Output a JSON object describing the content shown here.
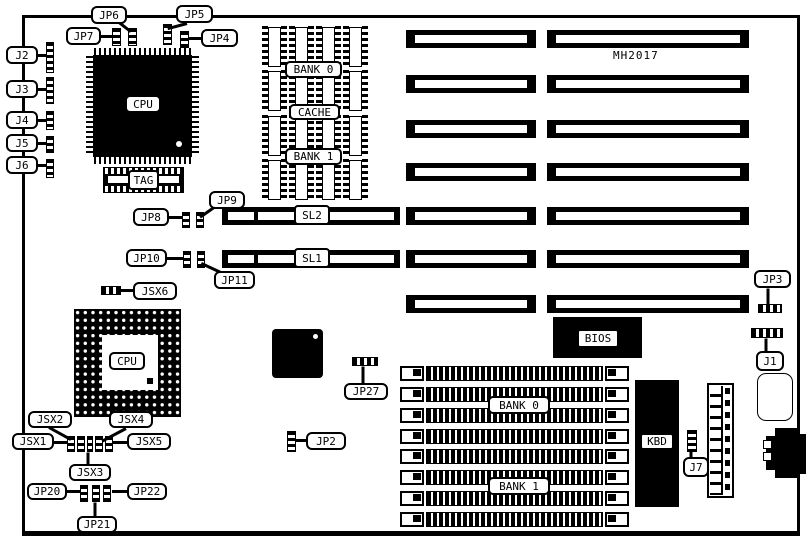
{
  "diagram": {
    "part_number": "MH2017",
    "labels": {
      "cpu_qfp": "CPU",
      "cpu_pga": "CPU",
      "tag": "TAG",
      "cache_bank0": "BANK 0",
      "cache": "CACHE",
      "cache_bank1": "BANK 1",
      "mem_bank0": "BANK 0",
      "mem_bank1": "BANK 1",
      "sl2": "SL2",
      "sl1": "SL1",
      "bios": "BIOS",
      "kbd": "KBD"
    },
    "structure": {
      "expansion_slot_rows": 7,
      "simm_sockets": 8,
      "cache_chip_columns": 4
    },
    "callouts": {
      "j1": "J1",
      "j2": "J2",
      "j3": "J3",
      "j4": "J4",
      "j5": "J5",
      "j6": "J6",
      "j7": "J7",
      "jp2": "JP2",
      "jp3": "JP3",
      "jp4": "JP4",
      "jp5": "JP5",
      "jp6": "JP6",
      "jp7": "JP7",
      "jp8": "JP8",
      "jp9": "JP9",
      "jp10": "JP10",
      "jp11": "JP11",
      "jp20": "JP20",
      "jp21": "JP21",
      "jp22": "JP22",
      "jp27": "JP27",
      "jsx1": "JSX1",
      "jsx2": "JSX2",
      "jsx3": "JSX3",
      "jsx4": "JSX4",
      "jsx5": "JSX5",
      "jsx6": "JSX6"
    }
  }
}
